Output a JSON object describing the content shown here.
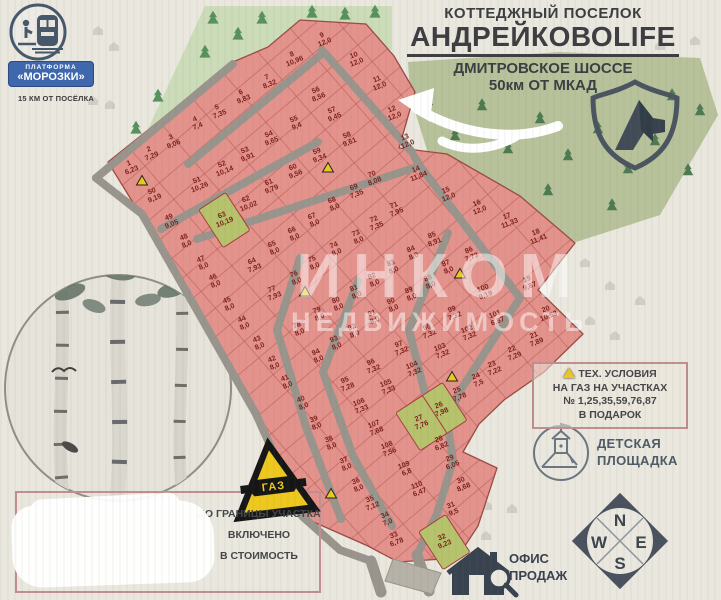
{
  "title_block": {
    "line1": "КОТТЕДЖНЫЙ ПОСЕЛОК",
    "line2": "АНДРЕЙКОВОLIFE",
    "line3": "ДМИТРОВСКОЕ ШОССЕ",
    "line4": "50км ОТ МКАД"
  },
  "station": {
    "badge_line1": "ПЛАТФОРМА",
    "badge_line2": "«МОРОЗКИ»",
    "distance_note": "15 КМ ОТ ПОСЁЛКА"
  },
  "legend": {
    "tech_line1": "ТЕХ. УСЛОВИЯ",
    "tech_line2": "НА ГАЗ НА УЧАСТКАХ",
    "tech_line3": "№ 1,25,35,59,76,87",
    "tech_line4": "В ПОДАРОК",
    "playground_line1": "ДЕТСКАЯ",
    "playground_line2": "ПЛОЩАДКА",
    "office_line1": "ОФИС",
    "office_line2": "ПРОДАЖ",
    "gas_sign": "ГАЗ",
    "boundary_line1": "ДО ГРАНИЦЫ УЧАСТКА",
    "boundary_line2": "ВКЛЮЧЕНО",
    "boundary_line3": "В СТОИМОСТЬ"
  },
  "compass": {
    "n": "N",
    "s": "S",
    "e": "E",
    "w": "W"
  },
  "watermark": {
    "line1": "ИНКОМ",
    "line2": "НЕДВИЖИМОСТЬ"
  },
  "colors": {
    "plot_pink": "#e4928c",
    "plot_green": "#b6c36c",
    "road_gray": "#99958c",
    "accent_red": "#7d211d",
    "forest_light": "#ccdcb8",
    "forest_olive": "#b7c29b",
    "badge_blue": "#3e67ae",
    "warning_yellow": "#eec81e"
  },
  "plots": [
    {
      "n": "1",
      "a": "6,23",
      "x": 130,
      "y": 166
    },
    {
      "n": "2",
      "a": "7,29",
      "x": 150,
      "y": 152
    },
    {
      "n": "3",
      "a": "9,06",
      "x": 172,
      "y": 140
    },
    {
      "n": "4",
      "a": "7,4",
      "x": 196,
      "y": 122
    },
    {
      "n": "5",
      "a": "7,35",
      "x": 218,
      "y": 110
    },
    {
      "n": "6",
      "a": "9,83",
      "x": 242,
      "y": 95
    },
    {
      "n": "7",
      "a": "8,32",
      "x": 268,
      "y": 80
    },
    {
      "n": "8",
      "a": "10,96",
      "x": 293,
      "y": 57
    },
    {
      "n": "9",
      "a": "12,0",
      "x": 323,
      "y": 38
    },
    {
      "n": "10",
      "a": "12,0",
      "x": 355,
      "y": 58
    },
    {
      "n": "11",
      "a": "12,0",
      "x": 378,
      "y": 82
    },
    {
      "n": "12",
      "a": "12,0",
      "x": 393,
      "y": 112
    },
    {
      "n": "13",
      "a": "12,0",
      "x": 406,
      "y": 140
    },
    {
      "n": "14",
      "a": "11,84",
      "x": 417,
      "y": 172
    },
    {
      "n": "15",
      "a": "12,0",
      "x": 447,
      "y": 193
    },
    {
      "n": "16",
      "a": "12,0",
      "x": 478,
      "y": 206
    },
    {
      "n": "17",
      "a": "11,33",
      "x": 508,
      "y": 219
    },
    {
      "n": "18",
      "a": "11,41",
      "x": 537,
      "y": 235
    },
    {
      "n": "19",
      "a": "9,87",
      "x": 528,
      "y": 282
    },
    {
      "n": "20",
      "a": "10,53",
      "x": 547,
      "y": 312
    },
    {
      "n": "21",
      "a": "7,89",
      "x": 535,
      "y": 338
    },
    {
      "n": "22",
      "a": "7,29",
      "x": 513,
      "y": 352
    },
    {
      "n": "23",
      "a": "7,22",
      "x": 493,
      "y": 367
    },
    {
      "n": "24",
      "a": "7,5",
      "x": 477,
      "y": 379
    },
    {
      "n": "25",
      "a": "7,78",
      "x": 458,
      "y": 393
    },
    {
      "n": "26",
      "a": "7,98",
      "x": 440,
      "y": 408,
      "green": true
    },
    {
      "n": "27",
      "a": "7,76",
      "x": 420,
      "y": 421,
      "green": true
    },
    {
      "n": "28",
      "a": "6,82",
      "x": 440,
      "y": 442
    },
    {
      "n": "29",
      "a": "6,05",
      "x": 451,
      "y": 461
    },
    {
      "n": "30",
      "a": "8,68",
      "x": 462,
      "y": 483
    },
    {
      "n": "31",
      "a": "9,5",
      "x": 452,
      "y": 508
    },
    {
      "n": "32",
      "a": "9,23",
      "x": 443,
      "y": 540,
      "green": true
    },
    {
      "n": "33",
      "a": "6,78",
      "x": 395,
      "y": 538
    },
    {
      "n": "34",
      "a": "7,0",
      "x": 386,
      "y": 518
    },
    {
      "n": "35",
      "a": "7,12",
      "x": 371,
      "y": 502
    },
    {
      "n": "36",
      "a": "8,0",
      "x": 357,
      "y": 484
    },
    {
      "n": "37",
      "a": "8,0",
      "x": 345,
      "y": 463
    },
    {
      "n": "38",
      "a": "8,0",
      "x": 330,
      "y": 442
    },
    {
      "n": "39",
      "a": "8,0",
      "x": 315,
      "y": 422
    },
    {
      "n": "40",
      "a": "8,0",
      "x": 302,
      "y": 402
    },
    {
      "n": "41",
      "a": "8,0",
      "x": 286,
      "y": 381
    },
    {
      "n": "42",
      "a": "8,0",
      "x": 273,
      "y": 362
    },
    {
      "n": "43",
      "a": "8,0",
      "x": 258,
      "y": 342
    },
    {
      "n": "44",
      "a": "8,0",
      "x": 243,
      "y": 322
    },
    {
      "n": "45",
      "a": "8,0",
      "x": 228,
      "y": 303
    },
    {
      "n": "46",
      "a": "8,0",
      "x": 214,
      "y": 280
    },
    {
      "n": "47",
      "a": "8,0",
      "x": 202,
      "y": 262
    },
    {
      "n": "48",
      "a": "8,0",
      "x": 185,
      "y": 240
    },
    {
      "n": "49",
      "a": "9,05",
      "x": 170,
      "y": 220
    },
    {
      "n": "50",
      "a": "9,19",
      "x": 153,
      "y": 194
    },
    {
      "n": "51",
      "a": "10,26",
      "x": 198,
      "y": 183
    },
    {
      "n": "52",
      "a": "10,14",
      "x": 223,
      "y": 167
    },
    {
      "n": "53",
      "a": "9,91",
      "x": 246,
      "y": 153
    },
    {
      "n": "54",
      "a": "9,65",
      "x": 270,
      "y": 137
    },
    {
      "n": "55",
      "a": "9,4",
      "x": 295,
      "y": 122
    },
    {
      "n": "56",
      "a": "8,56",
      "x": 317,
      "y": 93
    },
    {
      "n": "57",
      "a": "9,45",
      "x": 333,
      "y": 113
    },
    {
      "n": "58",
      "a": "9,61",
      "x": 348,
      "y": 138
    },
    {
      "n": "59",
      "a": "9,34",
      "x": 318,
      "y": 154
    },
    {
      "n": "60",
      "a": "9,56",
      "x": 294,
      "y": 170
    },
    {
      "n": "61",
      "a": "9,79",
      "x": 270,
      "y": 185
    },
    {
      "n": "62",
      "a": "10,02",
      "x": 247,
      "y": 202
    },
    {
      "n": "63",
      "a": "10,19",
      "x": 223,
      "y": 218,
      "green": true
    },
    {
      "n": "64",
      "a": "7,93",
      "x": 253,
      "y": 264
    },
    {
      "n": "65",
      "a": "8,0",
      "x": 273,
      "y": 247
    },
    {
      "n": "66",
      "a": "8,0",
      "x": 293,
      "y": 233
    },
    {
      "n": "67",
      "a": "8,0",
      "x": 313,
      "y": 219
    },
    {
      "n": "68",
      "a": "8,0",
      "x": 333,
      "y": 203
    },
    {
      "n": "69",
      "a": "7,35",
      "x": 355,
      "y": 190
    },
    {
      "n": "70",
      "a": "8,08",
      "x": 373,
      "y": 177
    },
    {
      "n": "71",
      "a": "7,95",
      "x": 395,
      "y": 208
    },
    {
      "n": "72",
      "a": "7,35",
      "x": 375,
      "y": 222
    },
    {
      "n": "73",
      "a": "8,0",
      "x": 357,
      "y": 236
    },
    {
      "n": "74",
      "a": "8,0",
      "x": 335,
      "y": 248
    },
    {
      "n": "75",
      "a": "8,0",
      "x": 313,
      "y": 262
    },
    {
      "n": "76",
      "a": "8,0",
      "x": 295,
      "y": 277
    },
    {
      "n": "77",
      "a": "7,93",
      "x": 273,
      "y": 292
    },
    {
      "n": "78",
      "a": "8,0",
      "x": 298,
      "y": 328
    },
    {
      "n": "79",
      "a": "8,0",
      "x": 318,
      "y": 313
    },
    {
      "n": "80",
      "a": "8,0",
      "x": 337,
      "y": 303
    },
    {
      "n": "81",
      "a": "8,0",
      "x": 355,
      "y": 291
    },
    {
      "n": "82",
      "a": "8,0",
      "x": 373,
      "y": 279
    },
    {
      "n": "83",
      "a": "8,0",
      "x": 392,
      "y": 266
    },
    {
      "n": "84",
      "a": "8,0",
      "x": 412,
      "y": 252
    },
    {
      "n": "85",
      "a": "8,91",
      "x": 433,
      "y": 238
    },
    {
      "n": "86",
      "a": "7,73",
      "x": 470,
      "y": 253
    },
    {
      "n": "87",
      "a": "8,0",
      "x": 447,
      "y": 266
    },
    {
      "n": "88",
      "a": "8,0",
      "x": 429,
      "y": 281
    },
    {
      "n": "89",
      "a": "8,0",
      "x": 410,
      "y": 293
    },
    {
      "n": "90",
      "a": "8,0",
      "x": 392,
      "y": 304
    },
    {
      "n": "91",
      "a": "8,0",
      "x": 373,
      "y": 316
    },
    {
      "n": "92",
      "a": "8,0",
      "x": 353,
      "y": 330
    },
    {
      "n": "93",
      "a": "8,0",
      "x": 335,
      "y": 342
    },
    {
      "n": "94",
      "a": "8,0",
      "x": 317,
      "y": 355
    },
    {
      "n": "95",
      "a": "7,28",
      "x": 346,
      "y": 383
    },
    {
      "n": "96",
      "a": "7,32",
      "x": 372,
      "y": 365
    },
    {
      "n": "97",
      "a": "7,32",
      "x": 400,
      "y": 347
    },
    {
      "n": "98",
      "a": "7,32",
      "x": 428,
      "y": 330
    },
    {
      "n": "99",
      "a": "7,32",
      "x": 453,
      "y": 312
    },
    {
      "n": "100",
      "a": "9,19",
      "x": 484,
      "y": 291
    },
    {
      "n": "101",
      "a": "6,87",
      "x": 496,
      "y": 317
    },
    {
      "n": "102",
      "a": "7,32",
      "x": 468,
      "y": 332
    },
    {
      "n": "103",
      "a": "7,32",
      "x": 441,
      "y": 350
    },
    {
      "n": "104",
      "a": "7,32",
      "x": 413,
      "y": 368
    },
    {
      "n": "105",
      "a": "7,33",
      "x": 387,
      "y": 386
    },
    {
      "n": "106",
      "a": "7,33",
      "x": 360,
      "y": 405
    },
    {
      "n": "107",
      "a": "7,68",
      "x": 375,
      "y": 427
    },
    {
      "n": "108",
      "a": "7,56",
      "x": 388,
      "y": 448
    },
    {
      "n": "109",
      "a": "6,8",
      "x": 405,
      "y": 468
    },
    {
      "n": "110",
      "a": "6,47",
      "x": 418,
      "y": 488
    }
  ],
  "gift_markers": [
    {
      "x": 142,
      "y": 181
    },
    {
      "x": 328,
      "y": 168
    },
    {
      "x": 305,
      "y": 292
    },
    {
      "x": 460,
      "y": 274
    },
    {
      "x": 452,
      "y": 377
    },
    {
      "x": 331,
      "y": 494
    }
  ]
}
